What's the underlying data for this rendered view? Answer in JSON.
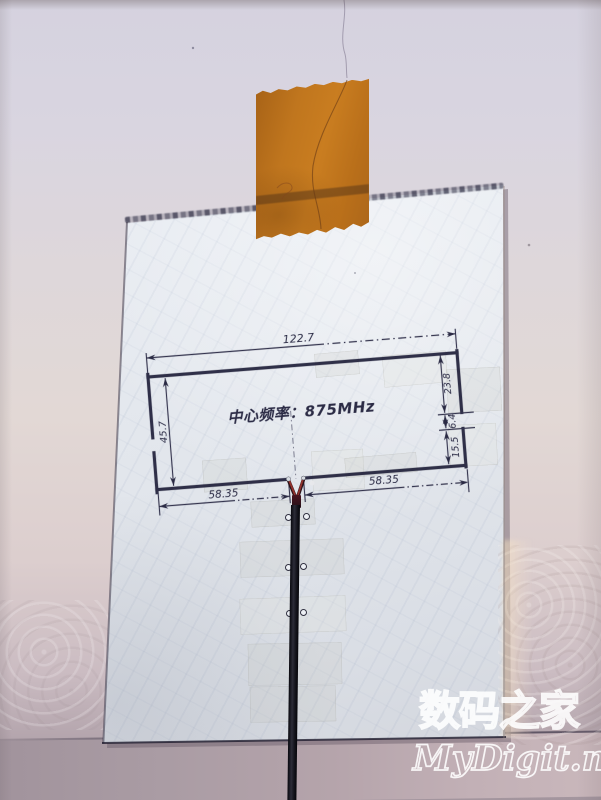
{
  "drawing": {
    "center_frequency_label": "中心频率：875MHz",
    "dims": {
      "top_width": "122.7",
      "left_height": "45.7",
      "right_upper": "23.8",
      "right_gap": "6.4",
      "right_lower": "15.5",
      "bottom_left": "58.35",
      "bottom_right": "58.35"
    }
  },
  "watermark": {
    "site_name": "数码之家",
    "site_url": "MyDigit.net"
  },
  "colors": {
    "wall_top": "#d5d2df",
    "wall_mid": "#e2d8d5",
    "wall_bottom_band": "#b5a4ab",
    "paper": "#e7ebf1",
    "tape_orange": "#c0761e",
    "ink": "#26263e",
    "cable": "#14141c",
    "solder_red": "#93312c",
    "watermark_outline": "#ffffff"
  }
}
